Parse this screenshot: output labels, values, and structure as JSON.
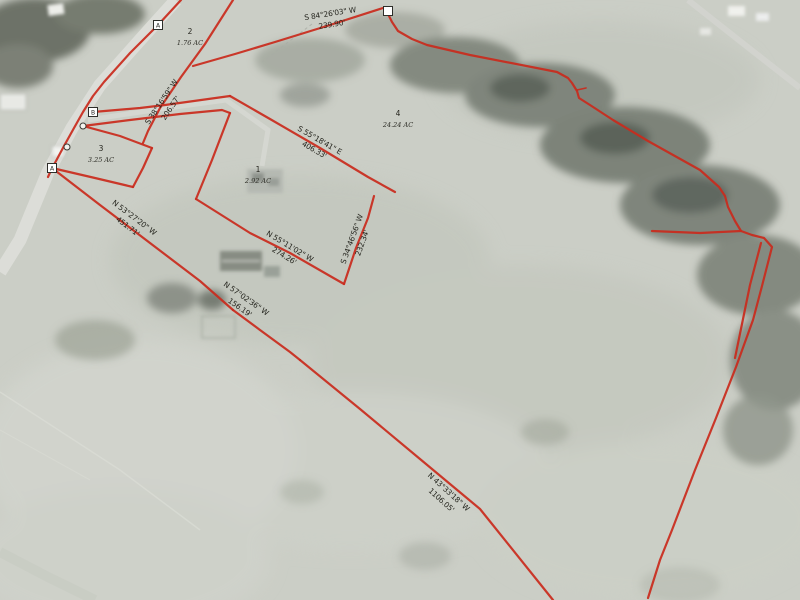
{
  "map": {
    "colors": {
      "boundary": "#c92b1d",
      "label_text": "#26261f",
      "field_base": "#cbcec6",
      "marker_fill": "#ffffff"
    },
    "parcels": [
      {
        "number": "1",
        "acreage": "2.92 AC",
        "x": 258,
        "y": 172
      },
      {
        "number": "2",
        "acreage": "1.76 AC",
        "x": 190,
        "y": 34
      },
      {
        "number": "3",
        "acreage": "3.25 AC",
        "x": 101,
        "y": 151
      },
      {
        "number": "4",
        "acreage": "24.24 AC",
        "x": 398,
        "y": 116
      }
    ],
    "bearings": [
      {
        "text": "S 84°26'03\" W",
        "length": "239.90'",
        "x": 331,
        "y": 19,
        "angle": -9
      },
      {
        "text": "S 38°16'59\" W",
        "length": "206.57'",
        "x": 166,
        "y": 105,
        "angle": -56
      },
      {
        "text": "S 55°18'41\" E",
        "length": "406.33'",
        "x": 317,
        "y": 145,
        "angle": 30
      },
      {
        "text": "S 34°46'56\" W",
        "length": "232.34'",
        "x": 357,
        "y": 241,
        "angle": -70
      },
      {
        "text": "N 55°11'02\" W",
        "length": "274.26'",
        "x": 287,
        "y": 251,
        "angle": 31
      },
      {
        "text": "N 53°27'20\" W",
        "length": "451.71'",
        "x": 131,
        "y": 222,
        "angle": 37
      },
      {
        "text": "N 57°02'36\" W",
        "length": "156.19'",
        "x": 243,
        "y": 303,
        "angle": 35
      },
      {
        "text": "N 43°33'18\" W",
        "length": "1106.05'",
        "x": 445,
        "y": 496,
        "angle": 42
      }
    ],
    "markers": [
      {
        "type": "square",
        "letter": "A",
        "x": 158,
        "y": 25
      },
      {
        "type": "square",
        "letter": "B",
        "x": 93,
        "y": 112
      },
      {
        "type": "square",
        "letter": "A",
        "x": 52,
        "y": 168
      },
      {
        "type": "square",
        "letter": "",
        "x": 388,
        "y": 11
      },
      {
        "type": "circle",
        "x": 83,
        "y": 126
      },
      {
        "type": "circle",
        "x": 67,
        "y": 147
      }
    ],
    "lines": [
      {
        "name": "road-east-boundary",
        "points": [
          [
            181,
            0
          ],
          [
            158,
            25
          ],
          [
            130,
            53
          ],
          [
            104,
            82
          ],
          [
            93,
            96
          ],
          [
            83,
            112
          ],
          [
            74,
            128
          ],
          [
            64,
            146
          ],
          [
            56,
            161
          ],
          [
            52,
            168
          ],
          [
            48,
            177
          ]
        ]
      },
      {
        "name": "bearing-38-line",
        "points": [
          [
            233,
            0
          ],
          [
            205,
            44
          ],
          [
            181,
            77
          ],
          [
            160,
            108
          ],
          [
            148,
            131
          ],
          [
            143,
            143
          ]
        ]
      },
      {
        "name": "bearing-84-line",
        "points": [
          [
            383,
            8
          ],
          [
            330,
            25
          ],
          [
            275,
            42
          ],
          [
            235,
            54
          ],
          [
            193,
            66
          ]
        ]
      },
      {
        "name": "northeast-boundary",
        "points": [
          [
            388,
            14
          ],
          [
            392,
            22
          ],
          [
            398,
            31
          ],
          [
            412,
            39
          ],
          [
            427,
            45
          ],
          [
            470,
            55
          ],
          [
            557,
            72
          ],
          [
            568,
            78
          ],
          [
            572,
            83
          ],
          [
            577,
            91
          ],
          [
            579,
            98
          ],
          [
            590,
            105
          ],
          [
            613,
            120
          ],
          [
            648,
            141
          ],
          [
            700,
            170
          ],
          [
            719,
            187
          ],
          [
            725,
            196
          ],
          [
            728,
            207
          ],
          [
            735,
            221
          ],
          [
            741,
            231
          ],
          [
            752,
            235
          ],
          [
            764,
            238
          ],
          [
            772,
            247
          ],
          [
            762,
            286
          ],
          [
            753,
            320
          ],
          [
            736,
            367
          ],
          [
            716,
            418
          ],
          [
            695,
            470
          ],
          [
            672,
            530
          ],
          [
            660,
            560
          ],
          [
            648,
            598
          ]
        ]
      },
      {
        "name": "spur-tick",
        "width": 1.6,
        "points": [
          [
            577,
            90
          ],
          [
            586,
            88
          ]
        ]
      },
      {
        "name": "inner-spur-line",
        "points": [
          [
            761,
            243
          ],
          [
            750,
            285
          ],
          [
            735,
            358
          ]
        ]
      },
      {
        "name": "hairpin-west-line",
        "points": [
          [
            652,
            231
          ],
          [
            700,
            233
          ],
          [
            741,
            231
          ]
        ]
      },
      {
        "name": "lane-north-line",
        "points": [
          [
            93,
            112
          ],
          [
            140,
            108
          ],
          [
            165,
            105
          ],
          [
            230,
            96
          ]
        ]
      },
      {
        "name": "bearing-55e-line",
        "points": [
          [
            230,
            96
          ],
          [
            270,
            119
          ],
          [
            320,
            148
          ],
          [
            368,
            177
          ],
          [
            395,
            192
          ]
        ]
      },
      {
        "name": "lane-south-line",
        "points": [
          [
            83,
            126
          ],
          [
            130,
            120
          ],
          [
            180,
            114
          ],
          [
            222,
            110
          ],
          [
            230,
            113
          ]
        ]
      },
      {
        "name": "parcel1-west-line",
        "points": [
          [
            230,
            113
          ],
          [
            212,
            160
          ],
          [
            196,
            199
          ]
        ]
      },
      {
        "name": "bearing-34-line",
        "points": [
          [
            374,
            196
          ],
          [
            368,
            218
          ],
          [
            356,
            248
          ],
          [
            344,
            284
          ]
        ]
      },
      {
        "name": "bearing-n55-line",
        "points": [
          [
            344,
            284
          ],
          [
            330,
            276
          ],
          [
            290,
            253
          ],
          [
            250,
            233
          ],
          [
            196,
            199
          ]
        ]
      },
      {
        "name": "bearing-n53-line",
        "points": [
          [
            52,
            168
          ],
          [
            100,
            205
          ],
          [
            150,
            243
          ],
          [
            200,
            281
          ],
          [
            233,
            310
          ]
        ]
      },
      {
        "name": "bearing-n57-line",
        "points": [
          [
            233,
            310
          ],
          [
            260,
            330
          ],
          [
            290,
            352
          ],
          [
            300,
            360
          ]
        ]
      },
      {
        "name": "bearing-n43-line",
        "points": [
          [
            300,
            360
          ],
          [
            360,
            409
          ],
          [
            420,
            459
          ],
          [
            480,
            509
          ],
          [
            553,
            600
          ]
        ]
      },
      {
        "name": "parcel3-north-line",
        "points": [
          [
            83,
            126
          ],
          [
            120,
            136
          ],
          [
            152,
            148
          ]
        ]
      },
      {
        "name": "parcel3-east-line",
        "points": [
          [
            152,
            148
          ],
          [
            143,
            168
          ],
          [
            133,
            187
          ]
        ]
      },
      {
        "name": "parcel3-south-line",
        "points": [
          [
            133,
            187
          ],
          [
            95,
            178
          ],
          [
            52,
            168
          ]
        ]
      }
    ]
  }
}
